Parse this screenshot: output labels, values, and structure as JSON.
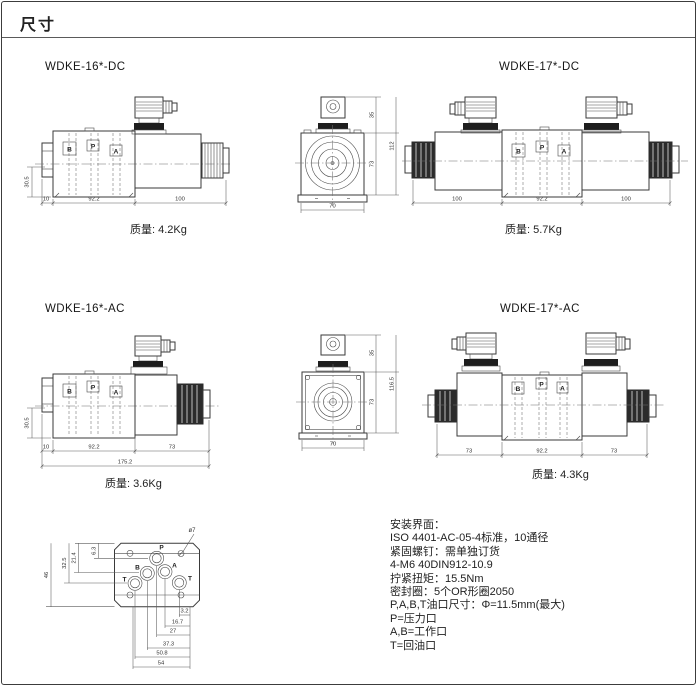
{
  "page": {
    "title": "尺寸"
  },
  "port_labels": {
    "b": "B",
    "p": "P",
    "a": "A",
    "t": "T"
  },
  "figures": {
    "dc16": {
      "title": "WDKE-16*-DC",
      "caption": "质量: 4.2Kg",
      "side": {
        "height": "30.5",
        "cap": "10",
        "body": "92.2",
        "sol": "100"
      },
      "front": {
        "conn": "35",
        "total": "112",
        "body": "73",
        "width": "70"
      }
    },
    "dc17": {
      "title": "WDKE-17*-DC",
      "caption": "质量: 5.7Kg",
      "dims": {
        "left": "100",
        "body": "92.2",
        "right": "100"
      }
    },
    "ac16": {
      "title": "WDKE-16*-AC",
      "caption": "质量: 3.6Kg",
      "side": {
        "height": "30.5",
        "cap": "10",
        "body": "92.2",
        "sol": "73",
        "total": "175.2"
      },
      "front": {
        "conn": "35",
        "total": "116.5",
        "body": "73",
        "width": "70"
      }
    },
    "ac17": {
      "title": "WDKE-17*-AC",
      "caption": "质量: 4.3Kg",
      "dims": {
        "left": "73",
        "body": "92.2",
        "right": "73"
      }
    }
  },
  "mounting": {
    "hole_note": "ø7",
    "vdims": [
      "6.3",
      "21.4",
      "32.5",
      "46"
    ],
    "hdims": [
      "3.2",
      "16.7",
      "27",
      "37.3",
      "50.8",
      "54"
    ]
  },
  "notes": {
    "lines": [
      "安装界面：",
      "ISO 4401-AC-05-4标准，10通径",
      "紧固螺钉：需单独订货",
      "4-M6 40DIN912-10.9",
      "拧紧扭矩：15.5Nm",
      "密封圈：5个OR形圈2050",
      "P,A,B,T油口尺寸：Φ=11.5mm(最大)",
      "P=压力口",
      "A,B=工作口",
      "T=回油口"
    ]
  }
}
